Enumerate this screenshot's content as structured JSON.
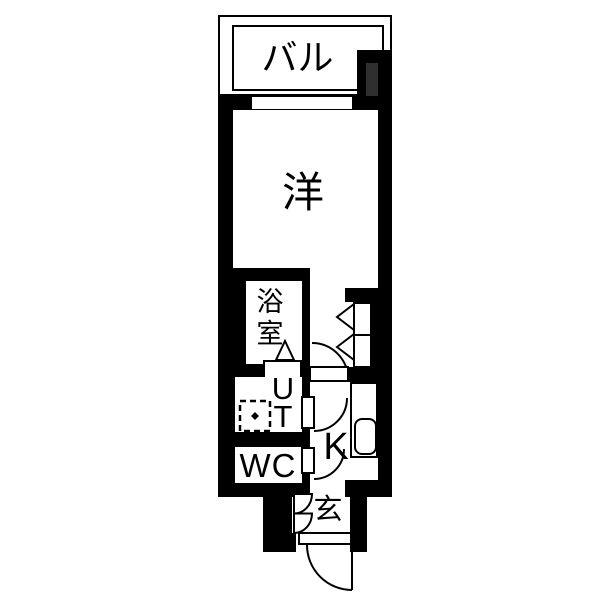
{
  "floorplan": {
    "type": "japanese-apartment-floorplan",
    "colors": {
      "wall": "#000000",
      "floor": "#ffffff",
      "shaft": "#2f2f2f"
    },
    "rooms": {
      "balcony": {
        "label": "バル"
      },
      "western": {
        "label": "洋"
      },
      "bath": {
        "char1": "浴",
        "char2": "室"
      },
      "utility": {
        "char1": "U",
        "char2": "T"
      },
      "toilet": {
        "label": "WC"
      },
      "kitchen": {
        "label": "K"
      },
      "entrance": {
        "label": "玄"
      }
    }
  }
}
